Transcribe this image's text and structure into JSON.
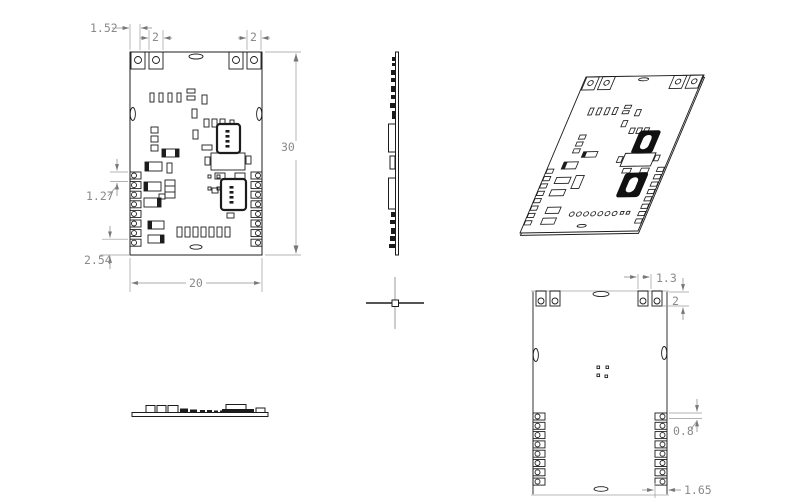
{
  "drawing": {
    "type": "pcb-module-mechanical-drawing",
    "units": "mm",
    "colors": {
      "background": "#ffffff",
      "outline": "#1c1c1c",
      "dimension_line": "#8f8f8f",
      "dimension_text": "#8a8a8a",
      "faint_edge": "#d0d0d0"
    },
    "dims": {
      "front": {
        "tab_offset": "1.52",
        "tab_width_left": "2",
        "tab_width_right": "2",
        "board_height": "30",
        "pad_pitch": "1.27",
        "pad_bottom_margin": "2.54",
        "board_width": "20"
      },
      "back": {
        "tab_spacing": "1.3",
        "tab_depth": "2",
        "pad_gap": "0.8",
        "pad_inset": "1.65"
      }
    }
  }
}
